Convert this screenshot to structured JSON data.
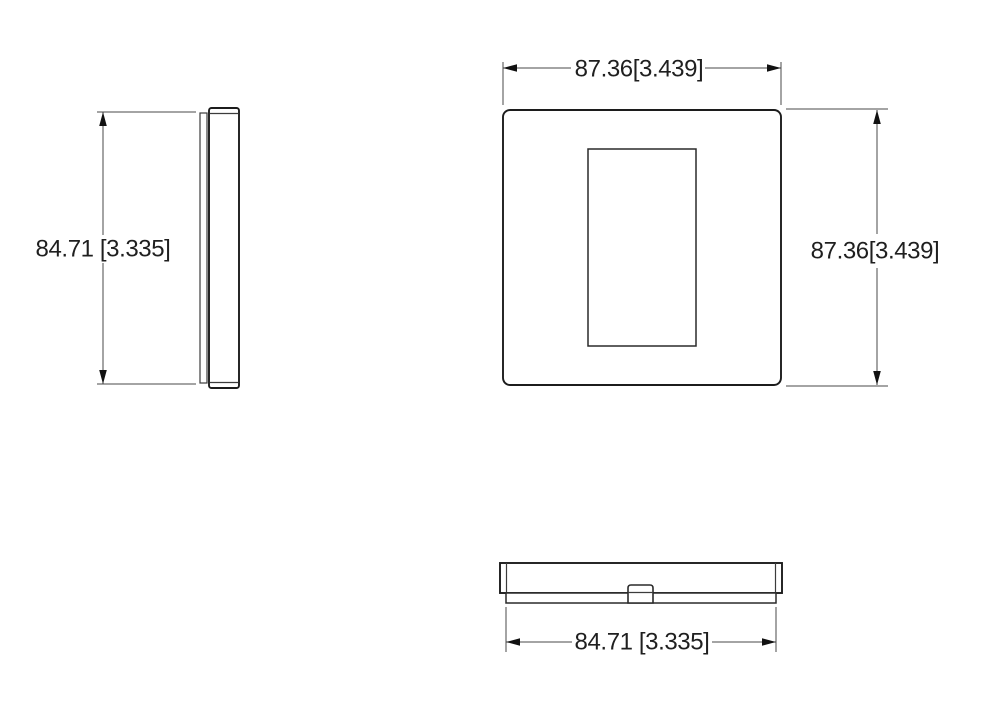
{
  "drawing": {
    "kind": "engineering-dimension-drawing",
    "subject": "square wall plate shown in three orthographic views (side, front, bottom)",
    "background_color": "#ffffff",
    "outline_color": "#1c1c1c",
    "dimension_line_color": "#4a4a4a",
    "text_color": "#1f1f1f",
    "views": {
      "side": {
        "name": "left side view"
      },
      "front": {
        "name": "front view with rectangular device opening"
      },
      "bottom": {
        "name": "bottom view with center snap tab"
      }
    },
    "dims": {
      "front_width": "87.36[3.439]",
      "front_height": "87.36[3.439]",
      "side_height": "84.71 [3.335]",
      "bottom_width": "84.71 [3.335]"
    }
  }
}
